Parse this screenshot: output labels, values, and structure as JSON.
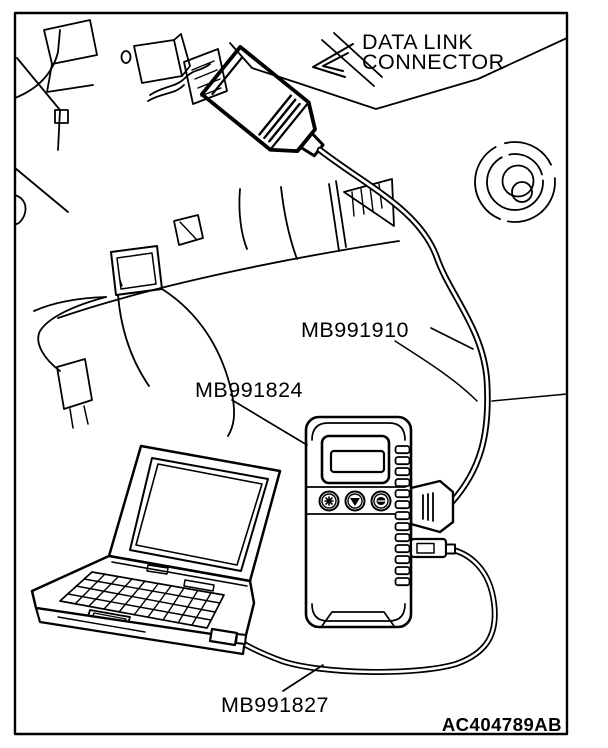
{
  "figure": {
    "kind": "service-manual-illustration",
    "colors": {
      "line": "#000000",
      "background": "#ffffff"
    },
    "labels": {
      "dlc_line1": "DATA LINK",
      "dlc_line2": "CONNECTOR",
      "cable_dlc_to_vci": "MB991910",
      "vci_unit": "MB991824",
      "cable_vci_to_pc": "MB991827",
      "figure_code": "AC404789AB"
    }
  }
}
